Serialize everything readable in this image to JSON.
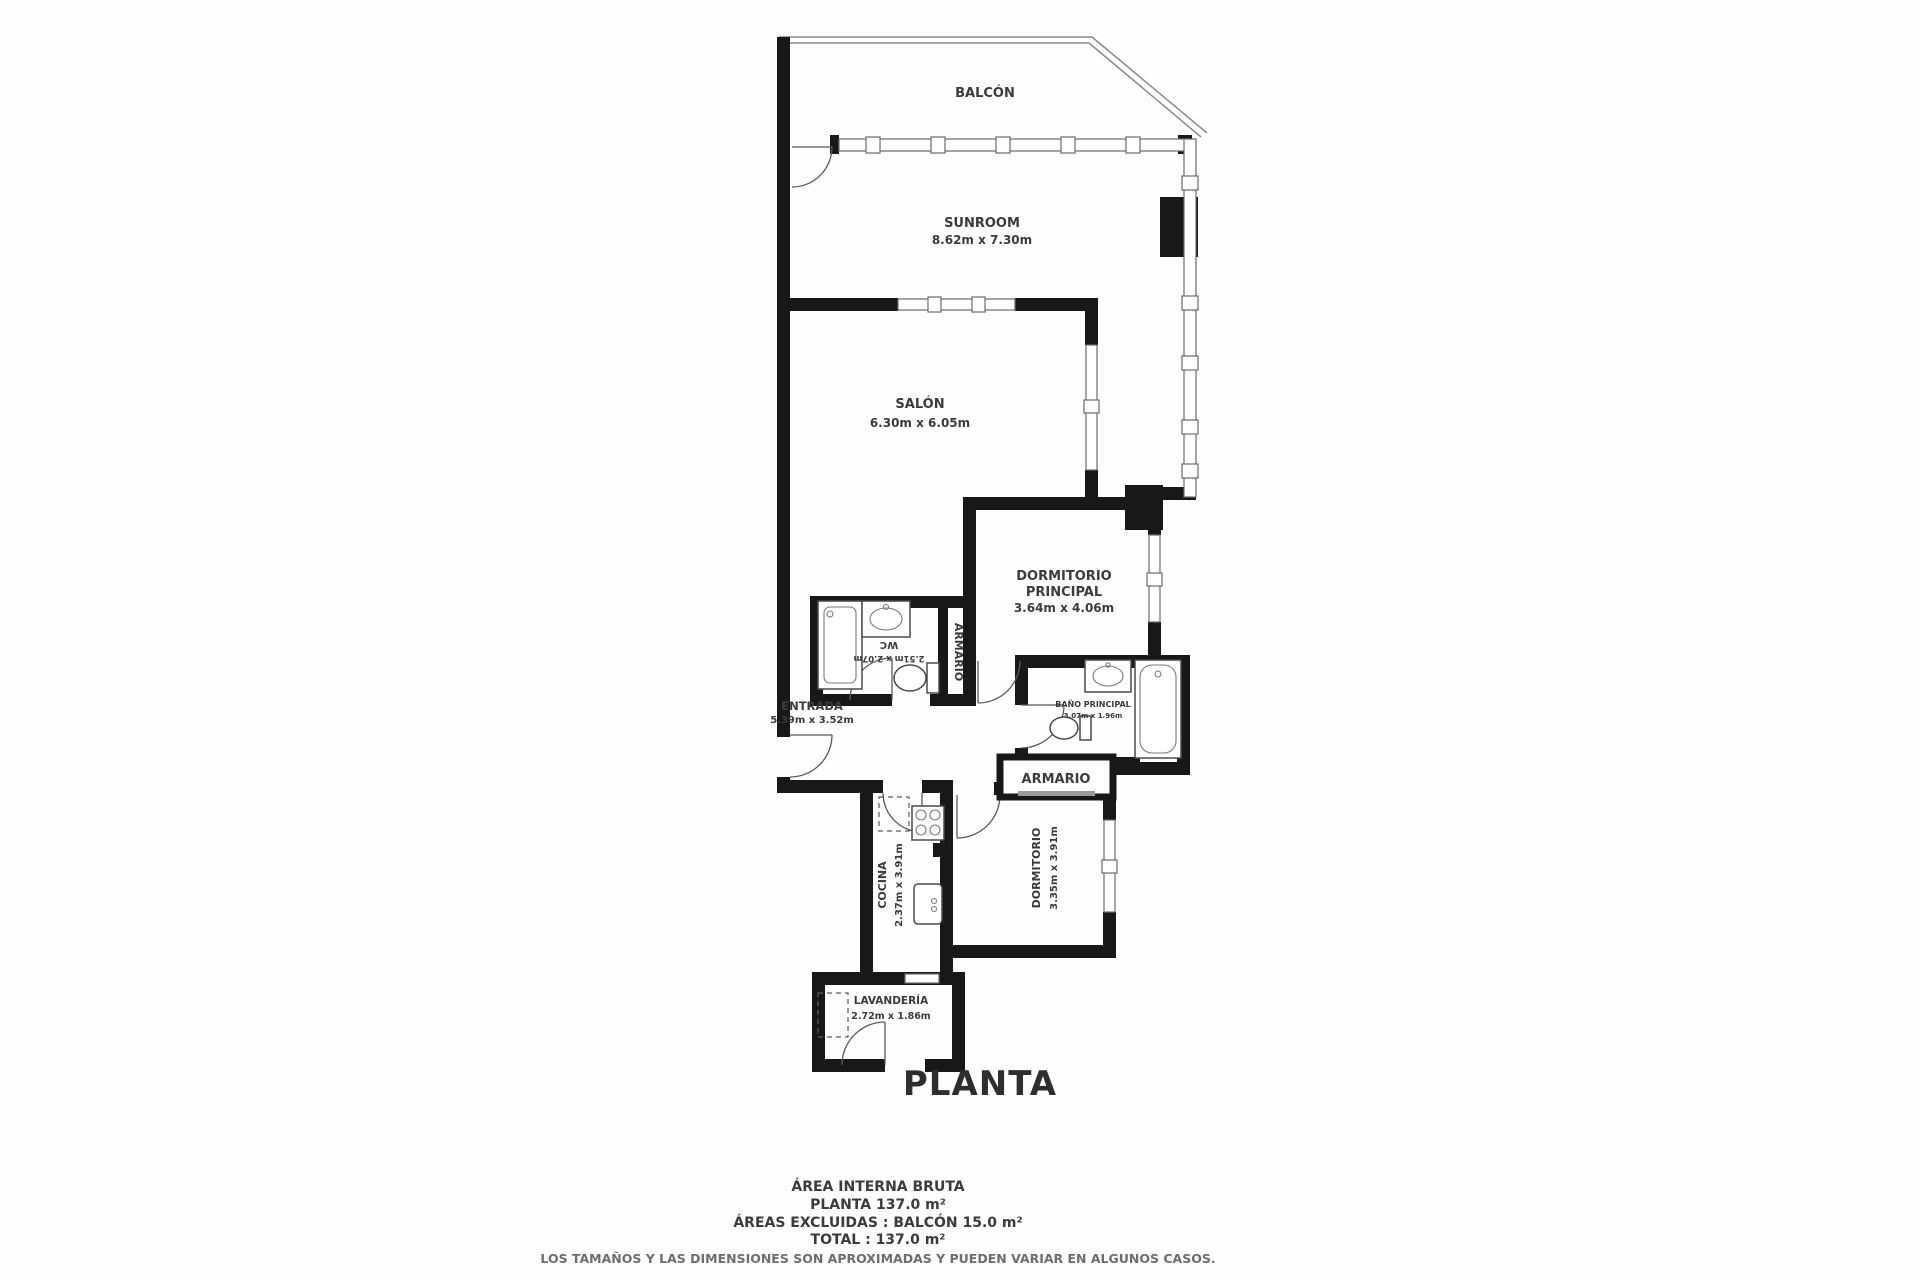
{
  "plan_title": "PLANTA",
  "rooms": {
    "balcon": {
      "name": "BALCÓN"
    },
    "sunroom": {
      "name": "SUNROOM",
      "dims": "8.62m x 7.30m"
    },
    "salon": {
      "name": "SALÓN",
      "dims": "6.30m x 6.05m"
    },
    "dormitorio_principal": {
      "name_line1": "DORMITORIO",
      "name_line2": "PRINCIPAL",
      "dims": "3.64m x 4.06m"
    },
    "wc": {
      "name": "WC",
      "dims": "2.51m x 2.07m"
    },
    "armario_pasillo": {
      "name": "ARMARIO"
    },
    "entrada": {
      "name": "ENTRADA",
      "dims": "5.39m x 3.52m"
    },
    "bano_principal": {
      "name": "BAÑO PRINCIPAL",
      "dims": "3.07m x 1.96m"
    },
    "armario_closet": {
      "name": "ARMARIO"
    },
    "cocina": {
      "name": "COCINA",
      "dims": "2.37m x 3.91m"
    },
    "dormitorio": {
      "name": "DORMITORIO",
      "dims": "3.35m x 3.91m"
    },
    "lavanderia": {
      "name": "LAVANDERÍA",
      "dims": "2.72m x 1.86m"
    }
  },
  "summary": {
    "line1": "ÁREA INTERNA BRUTA",
    "line2": "PLANTA 137.0 m²",
    "line3": "ÁREAS EXCLUIDAS :  BALCÓN 15.0 m²",
    "line4": "TOTAL :  137.0 m²",
    "disclaimer": "LOS TAMAÑOS Y LAS DIMENSIONES SON APROXIMADAS Y PUEDEN VARIAR EN ALGUNOS CASOS."
  },
  "colors": {
    "wall": "#181818",
    "line": "#6a6a6a",
    "text": "#3b3b3b",
    "background": "#ffffff"
  }
}
